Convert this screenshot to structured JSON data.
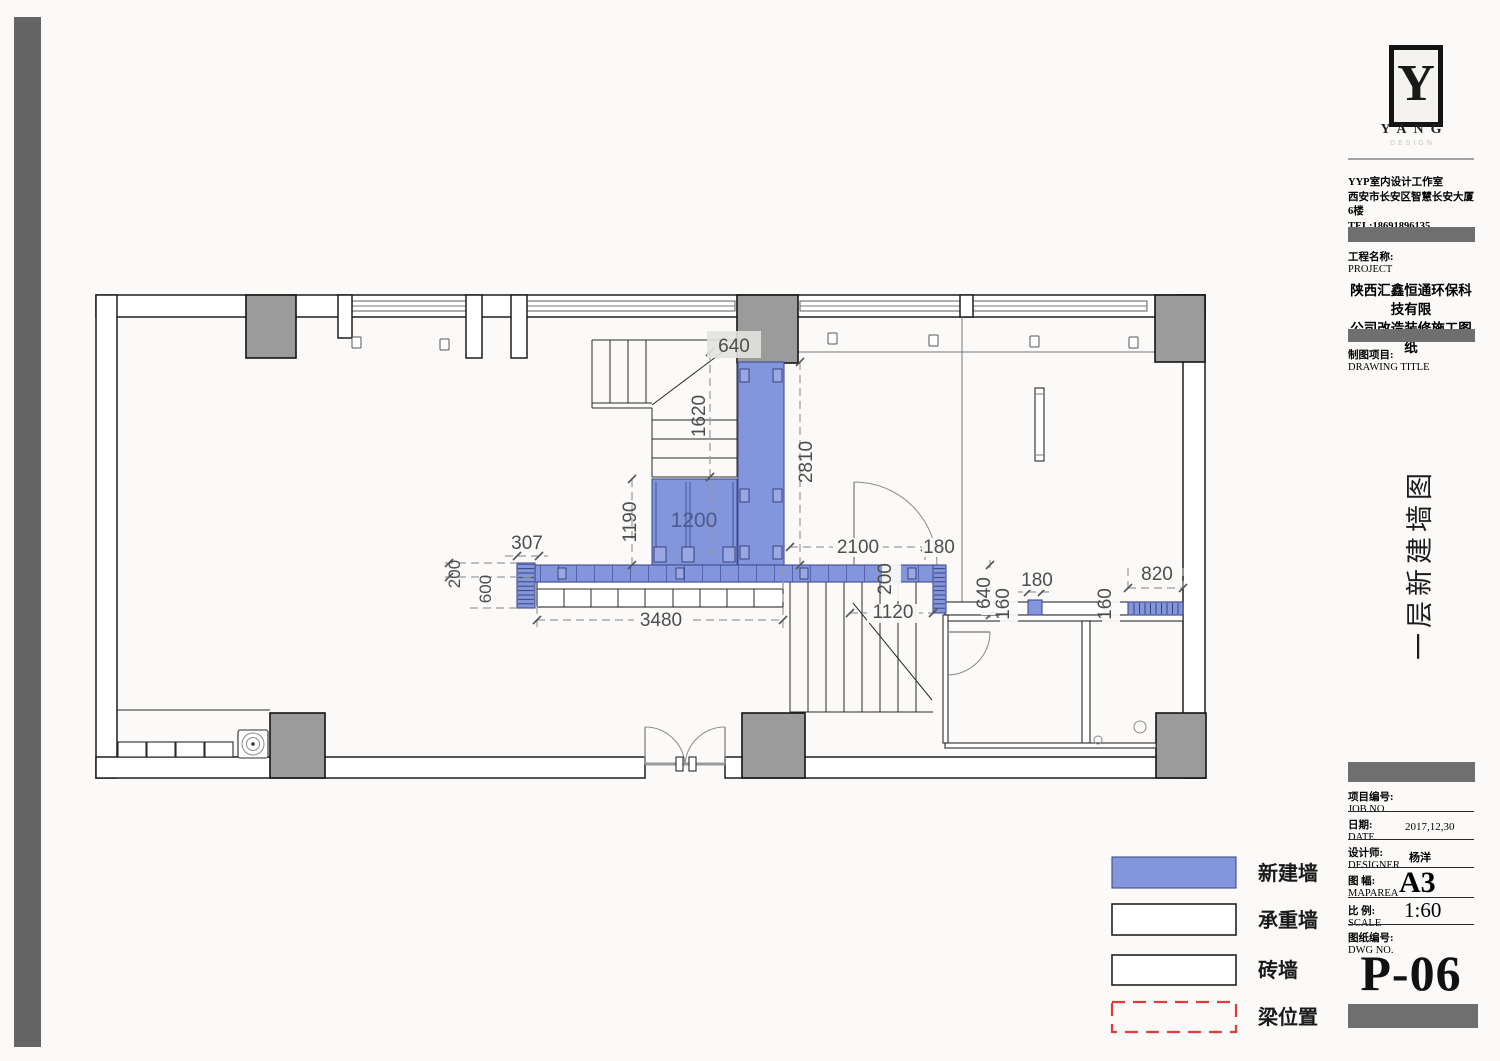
{
  "colors": {
    "new_wall_fill": "#8496DB",
    "new_wall_stroke": "#3F4C94",
    "column_fill": "#9B9B9B",
    "beam_dash_red": "#E03A3A",
    "dim_text": "#4d4d4d",
    "bar_gray": "#6f6f6f"
  },
  "plan": {
    "dims": {
      "col640": "640",
      "v1620": "1620",
      "v2810": "2810",
      "v1190": "1190",
      "b1200": "1200",
      "d307": "307",
      "v200_left": "200",
      "v600": "600",
      "d2100": "2100",
      "d180_door": "180",
      "v200_band": "200",
      "d3480": "3480",
      "d1120": "1120",
      "v640": "640",
      "v160_a": "160",
      "d180_b": "180",
      "v160_b": "160",
      "d820": "820"
    }
  },
  "legend": {
    "items": [
      {
        "label": "新建墙",
        "type": "new-wall"
      },
      {
        "label": "承重墙",
        "type": "load-bearing-wall"
      },
      {
        "label": "砖墙",
        "type": "brick-wall"
      },
      {
        "label": "梁位置",
        "type": "beam-position"
      }
    ]
  },
  "titleblock": {
    "logo": {
      "mark": "Y",
      "text": "YANG",
      "sub": "DESIGN"
    },
    "studio": {
      "line1": "YYP室内设计工作室",
      "line2": "西安市长安区智慧长安大厦6楼",
      "line3": "TEL:18691896135"
    },
    "project": {
      "label_cn": "工程名称:",
      "label_en": "PROJECT",
      "name_line1": "陕西汇鑫恒通环保科技有限",
      "name_line2": "公司改造装修施工图纸"
    },
    "drawing": {
      "label_cn": "制图项目:",
      "label_en": "DRAWING TITLE",
      "title_vertical": "一层新建墙图"
    },
    "fields": [
      {
        "cn": "项目编号:",
        "en": "JOB NO.",
        "value": ""
      },
      {
        "cn": "日期:",
        "en": "DATE",
        "value": "2017,12,30"
      },
      {
        "cn": "设计师:",
        "en": "DESIGNER",
        "value": "杨洋"
      },
      {
        "cn": "图 幅:",
        "en": "MAPAREA",
        "value": "A3"
      },
      {
        "cn": "比 例:",
        "en": "SCALE",
        "value": "1:60"
      },
      {
        "cn": "图纸编号:",
        "en": "DWG NO.",
        "value": ""
      }
    ],
    "sheet_no": "P-06"
  }
}
